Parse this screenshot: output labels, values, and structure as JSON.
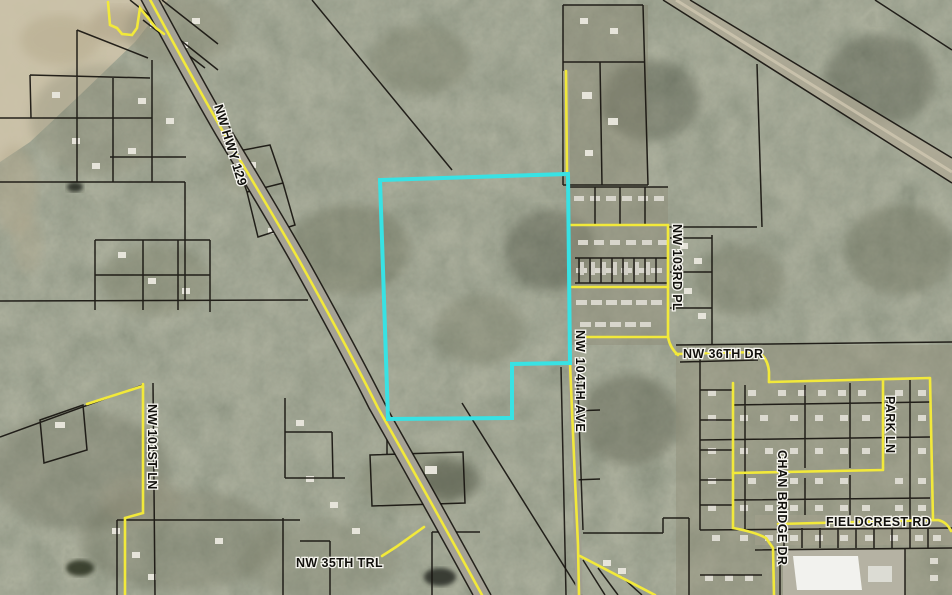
{
  "map": {
    "type": "aerial-parcel-map",
    "highlight_color": "#38e2e4",
    "road_color": "#f2e93a",
    "parcel_line_color": "#17140f",
    "labels": {
      "hwy129": "NW HWY 129",
      "nw101st": "NW 101ST LN",
      "nw35th": "NW 35TH TRL",
      "nw104th": "NW 104TH AVE",
      "nw103rd": "NW 103RD PL",
      "nw36th": "NW 36TH DR",
      "park_ln": "PARK LN",
      "chanbridge": "CHAN BRIDGE DR",
      "fieldcrest": "FIELDCREST RD"
    }
  }
}
